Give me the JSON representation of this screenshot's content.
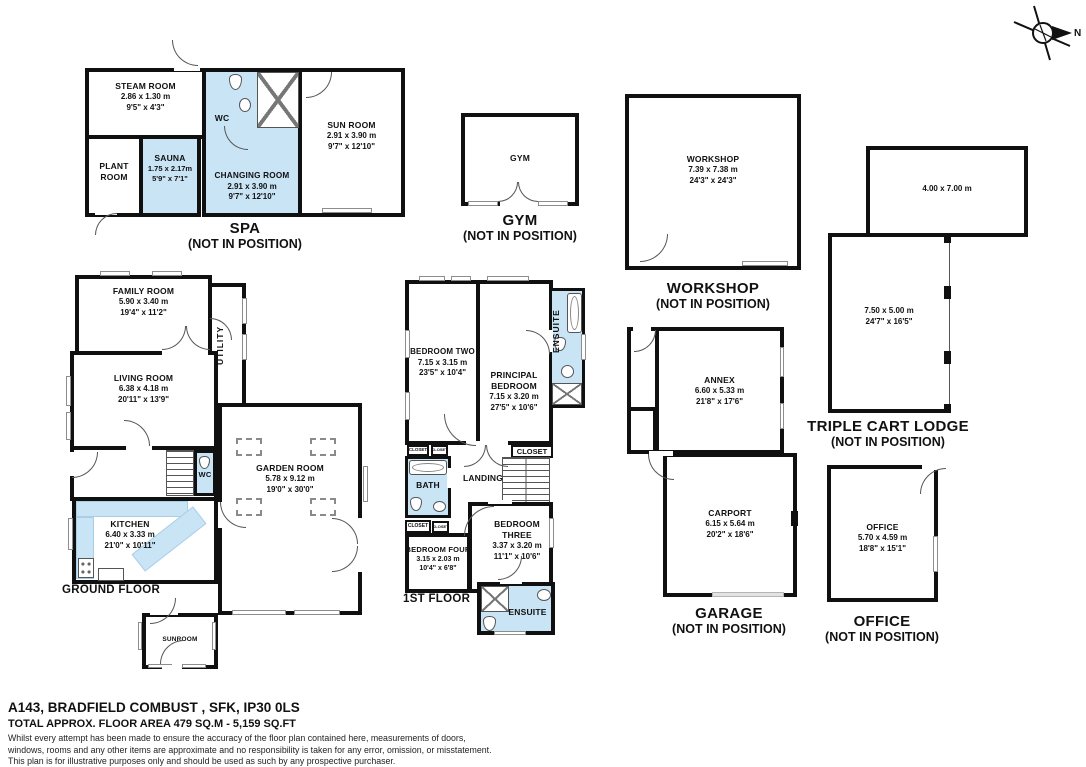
{
  "colors": {
    "wet_room": "#c8e4f5",
    "wall": "#101010",
    "window_frame": "#8d8d8d"
  },
  "compass": {
    "north_label": "N"
  },
  "spa": {
    "title": "SPA",
    "note": "(NOT IN POSITION)",
    "steam": {
      "name": "STEAM ROOM",
      "m": "2.86 x 1.30 m",
      "ft": "9'5\" x 4'3\""
    },
    "plant": {
      "line1": "PLANT",
      "line2": "ROOM"
    },
    "sauna": {
      "name": "SAUNA",
      "m": "1.75 x 2.17m",
      "ft": "5'9\" x 7'1\""
    },
    "changing": {
      "name": "CHANGING ROOM",
      "m": "2.91 x 3.90 m",
      "ft": "9'7\" x 12'10\""
    },
    "wc_label": "WC",
    "sun": {
      "name": "SUN ROOM",
      "m": "2.91 x 3.90 m",
      "ft": "9'7\" x 12'10\""
    }
  },
  "gym": {
    "room_label": "GYM",
    "title": "GYM",
    "note": "(NOT IN POSITION)"
  },
  "workshop": {
    "name": "WORKSHOP",
    "m": "7.39 x 7.38 m",
    "ft": "24'3\" x 24'3\"",
    "title": "WORKSHOP",
    "note": "(NOT IN POSITION)"
  },
  "cart_lodge": {
    "upper_m": "4.00 x 7.00 m",
    "lower_m": "7.50 x 5.00 m",
    "lower_ft": "24'7\" x 16'5\"",
    "title": "TRIPLE CART LODGE",
    "note": "(NOT IN POSITION)"
  },
  "annex": {
    "name": "ANNEX",
    "m": "6.60 x 5.33 m",
    "ft": "21'8\" x 17'6\""
  },
  "garage": {
    "name": "CARPORT",
    "m": "6.15 x 5.64 m",
    "ft": "20'2\" x 18'6\"",
    "title": "GARAGE",
    "note": "(NOT IN POSITION)"
  },
  "office": {
    "name": "OFFICE",
    "m": "5.70 x 4.59 m",
    "ft": "18'8\" x 15'1\"",
    "title": "OFFICE",
    "note": "(NOT IN POSITION)"
  },
  "ground_floor": {
    "label": "GROUND FLOOR",
    "family": {
      "name": "FAMILY ROOM",
      "m": "5.90 x 3.40 m",
      "ft": "19'4\" x 11'2\""
    },
    "utility_label": "UTILITY",
    "living": {
      "name": "LIVING ROOM",
      "m": "6.38 x 4.18 m",
      "ft": "20'11\" x 13'9\""
    },
    "wc_label": "WC",
    "kitchen": {
      "name": "KITCHEN",
      "m": "6.40 x 3.33 m",
      "ft": "21'0\" x 10'11\""
    },
    "garden": {
      "name": "GARDEN ROOM",
      "m": "5.78 x 9.12 m",
      "ft": "19'0\" x 30'0\""
    },
    "sunroom_label": "SUNROOM"
  },
  "first_floor": {
    "label": "1ST FLOOR",
    "bedroom_two": {
      "name": "BEDROOM TWO",
      "m": "7.15 x 3.15 m",
      "ft": "23'5\" x 10'4\""
    },
    "principal": {
      "name1": "PRINCIPAL",
      "name2": "BEDROOM",
      "m": "7.15 x 3.20 m",
      "ft": "27'5\" x 10'6\""
    },
    "ensuite_top_label": "ENSUITE",
    "closet_label": "CLOSET",
    "landing_label": "LANDING",
    "bath_label": "BATH",
    "bedroom_three": {
      "name1": "BEDROOM",
      "name2": "THREE",
      "m": "3.37 x 3.20 m",
      "ft": "11'1\" x 10'6\""
    },
    "bedroom_four": {
      "name": "BEDROOM FOUR",
      "m": "3.15 x 2.03 m",
      "ft": "10'4\" x 6'8\""
    },
    "ensuite_bottom_label": "ENSUITE"
  },
  "footer": {
    "address": "A143, BRADFIELD COMBUST , SFK, IP30 0LS",
    "area": "TOTAL APPROX. FLOOR AREA 479 SQ.M - 5,159 SQ.FT",
    "disclaimer_line1": "Whilst every attempt has been made to ensure the accuracy of the floor plan contained here, measurements of doors,",
    "disclaimer_line2": "windows, rooms and any other items are approximate and no responsibility is taken for any error, omission, or misstatement.",
    "disclaimer_line3": "This plan is for illustrative purposes only and should be used as such by any prospective purchaser."
  }
}
